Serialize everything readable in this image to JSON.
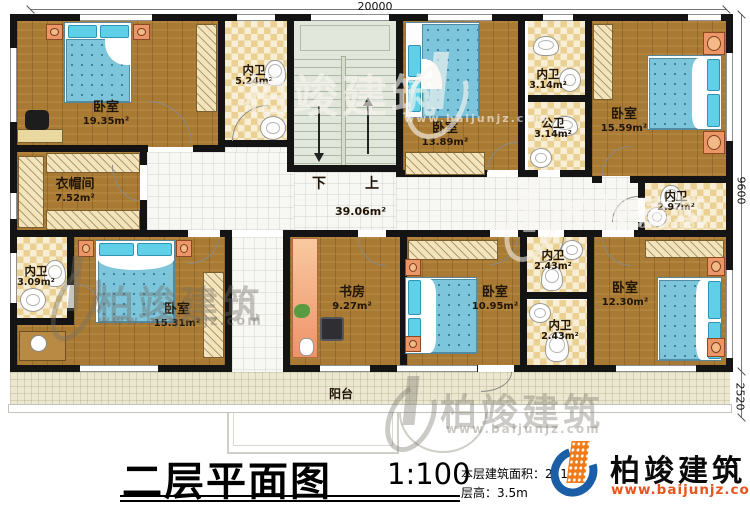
{
  "dimensions": {
    "width": "20000",
    "height": "9600",
    "balcony": "2520"
  },
  "rooms": {
    "bedroom_tl": {
      "name": "卧室",
      "area": "19.35m²"
    },
    "bath_top": {
      "name": "内卫",
      "area": "5.24m²"
    },
    "bedroom_top_mid": {
      "name": "卧室",
      "area": "13.89m²"
    },
    "bath_inner_top": {
      "name": "内卫",
      "area": "3.14m²"
    },
    "bath_public": {
      "name": "公卫",
      "area": "3.14m²"
    },
    "bedroom_tr": {
      "name": "卧室",
      "area": "15.59m²"
    },
    "closet_room": {
      "name": "衣帽间",
      "area": "7.52m²"
    },
    "bath_right": {
      "name": "内卫",
      "area": "2.97m²"
    },
    "bath_bl": {
      "name": "内卫",
      "area": "3.09m²"
    },
    "bedroom_bl": {
      "name": "卧室",
      "area": "15.31m²"
    },
    "study": {
      "name": "书房",
      "area": "9.27m²"
    },
    "bedroom_bottom_mid": {
      "name": "卧室",
      "area": "10.95m²"
    },
    "bath_mid_upper": {
      "name": "内卫",
      "area": "2.43m²"
    },
    "bath_mid_lower": {
      "name": "内卫",
      "area": "2.43m²"
    },
    "bedroom_br": {
      "name": "卧室",
      "area": "12.30m²"
    }
  },
  "hallway": {
    "area": "39.06m²"
  },
  "stairs": {
    "down": "下",
    "up": "上"
  },
  "balcony": {
    "label": "阳台"
  },
  "title_block": {
    "title": "二层平面图",
    "scale": "1:100",
    "area_text": "本层建筑面积：211.",
    "height_text": "层高：3.5m"
  },
  "brand": {
    "name": "柏竣建筑",
    "url": "www.baijunjz.com"
  },
  "colors": {
    "wall": "#141414",
    "wood": "#a87a33",
    "checker": "#ead092",
    "bed": "#7cc5da",
    "balcony": "#ebe7d0",
    "logo_blue": "#1a5ea6",
    "logo_orange": "#f07a18",
    "url_red": "#e8541e"
  }
}
